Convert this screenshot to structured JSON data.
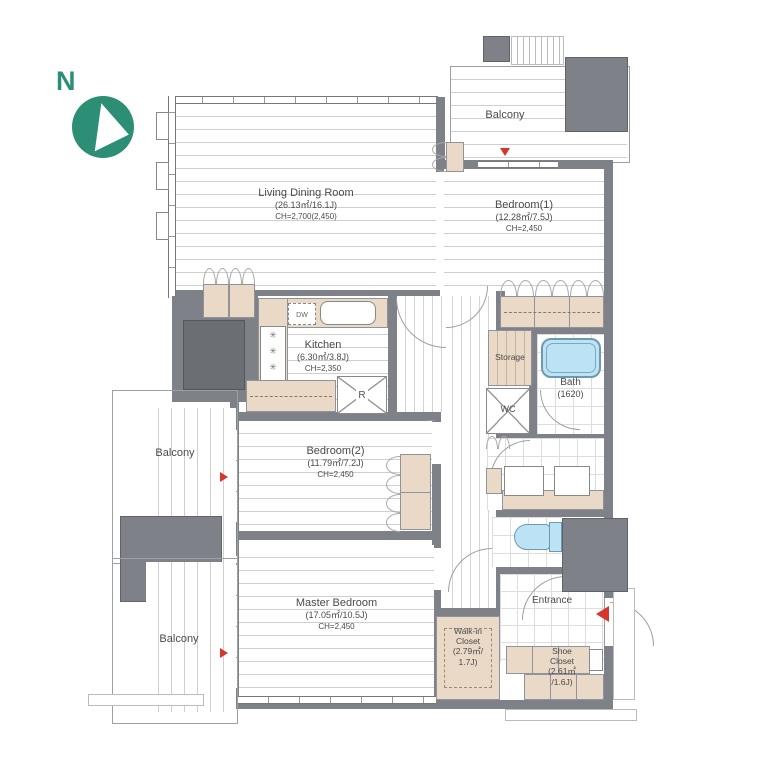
{
  "compass": {
    "label": "N"
  },
  "colors": {
    "wall": "#7e8288",
    "wall_dark": "#6b6f74",
    "closet_tan": "#e9d9c6",
    "tub_blue": "#bce3f5",
    "compass_green": "#2c8e74",
    "marker_red": "#d5372e"
  },
  "rooms": {
    "living": {
      "name": "Living Dining Room",
      "area": "(26.13㎡/16.1J)",
      "ch": "CH=2,700(2,450)"
    },
    "bedroom1": {
      "name": "Bedroom(1)",
      "area": "(12.28㎡/7.5J)",
      "ch": "CH=2,450"
    },
    "kitchen": {
      "name": "Kitchen",
      "area": "(6.30㎡/3.8J)",
      "ch": "CH=2,350"
    },
    "bedroom2": {
      "name": "Bedroom(2)",
      "area": "(11.79㎡/7.2J)",
      "ch": "CH=2,450"
    },
    "master": {
      "name": "Master Bedroom",
      "area": "(17.05㎡/10.5J)",
      "ch": "CH=2,450"
    },
    "bath": {
      "name": "Bath",
      "size": "(1620)"
    },
    "storage": {
      "name": "Storage"
    },
    "wc": {
      "name": "WC"
    },
    "entrance": {
      "name": "Entrance"
    },
    "walkin_closet": {
      "line1": "Walk-in",
      "line2": "Closet",
      "line3": "(2.79㎡/",
      "line4": "1.7J)"
    },
    "shoe_closet": {
      "line1": "Shoe",
      "line2": "Closet",
      "line3": "(2.61㎡",
      "line4": "/1.6J)"
    },
    "balcony_top": {
      "name": "Balcony"
    },
    "balcony_mid": {
      "name": "Balcony"
    },
    "balcony_bottom": {
      "name": "Balcony"
    }
  },
  "fixtures": {
    "dishwasher": "DW",
    "refrigerator": "R"
  }
}
